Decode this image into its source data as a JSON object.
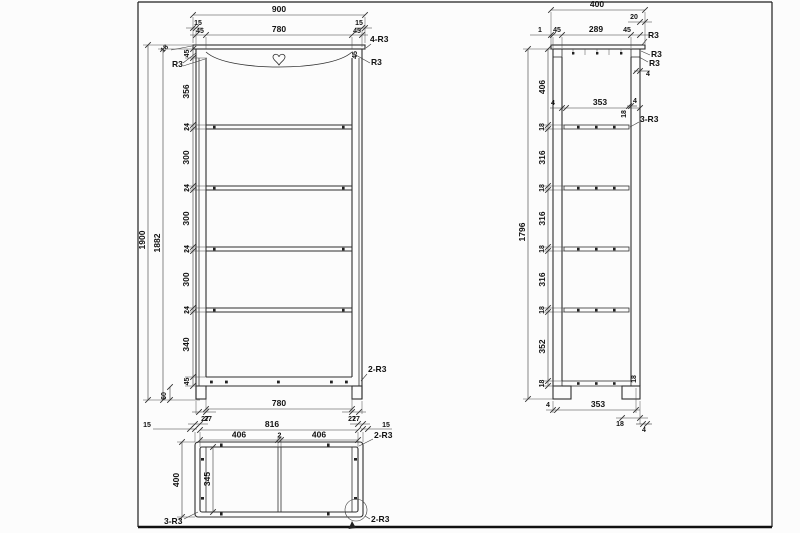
{
  "meta": {
    "description": "Three-view furniture engineering drawing of a tall bookshelf",
    "line_color": "#2e2e2e",
    "background": "#fcfcfc"
  },
  "front": {
    "width_overall": "900",
    "margin_left": "15",
    "margin_right": "15",
    "stile_left": "45",
    "stile_right": "45",
    "width_inner": "780",
    "note_top_right": "4-R3",
    "thickness_top": "18",
    "note_r3_left": "R3",
    "note_r3_right": "R3",
    "rail_right": "45",
    "height_overall": "1900",
    "height_inner": "1882",
    "chain": [
      "45",
      "356",
      "24",
      "300",
      "24",
      "300",
      "24",
      "300",
      "24",
      "340",
      "45"
    ],
    "leg_height": "60",
    "width_bottom": "780",
    "offset_left": "27",
    "offset_right": "27",
    "note_bottom_right": "2-R3"
  },
  "plan": {
    "margin_left": "15",
    "frame_left": "27",
    "width_inner": "816",
    "divider": "2",
    "half_left": "406",
    "half_right": "406",
    "frame_right": "27",
    "margin_right": "15",
    "note_top_right": "2-R3",
    "depth_overall": "400",
    "depth_inner": "345",
    "note_bottom_left": "3-R3",
    "note_corner": "2-R3"
  },
  "side": {
    "width_overall": "400",
    "overhang_back": "20",
    "gap_front": "1",
    "post_front": "45",
    "width_inner": "289",
    "post_back": "45",
    "note_r3_top": "R3",
    "note_r3_mid": "R3",
    "note_r3_low": "R3",
    "gap_back": "4",
    "gap_shelf": "4",
    "thickness_shelf": "18",
    "note_shelf": "3-R3",
    "shelf_gap_front": "4",
    "shelf_width": "353",
    "height_overall": "1796",
    "chain": [
      "406",
      "18",
      "316",
      "18",
      "316",
      "18",
      "316",
      "18",
      "352",
      "18"
    ],
    "thickness_bottom": "18",
    "bottom_gap_front": "4",
    "bottom_width": "353",
    "bottom_leg": "18",
    "bottom_gap_back": "4"
  }
}
